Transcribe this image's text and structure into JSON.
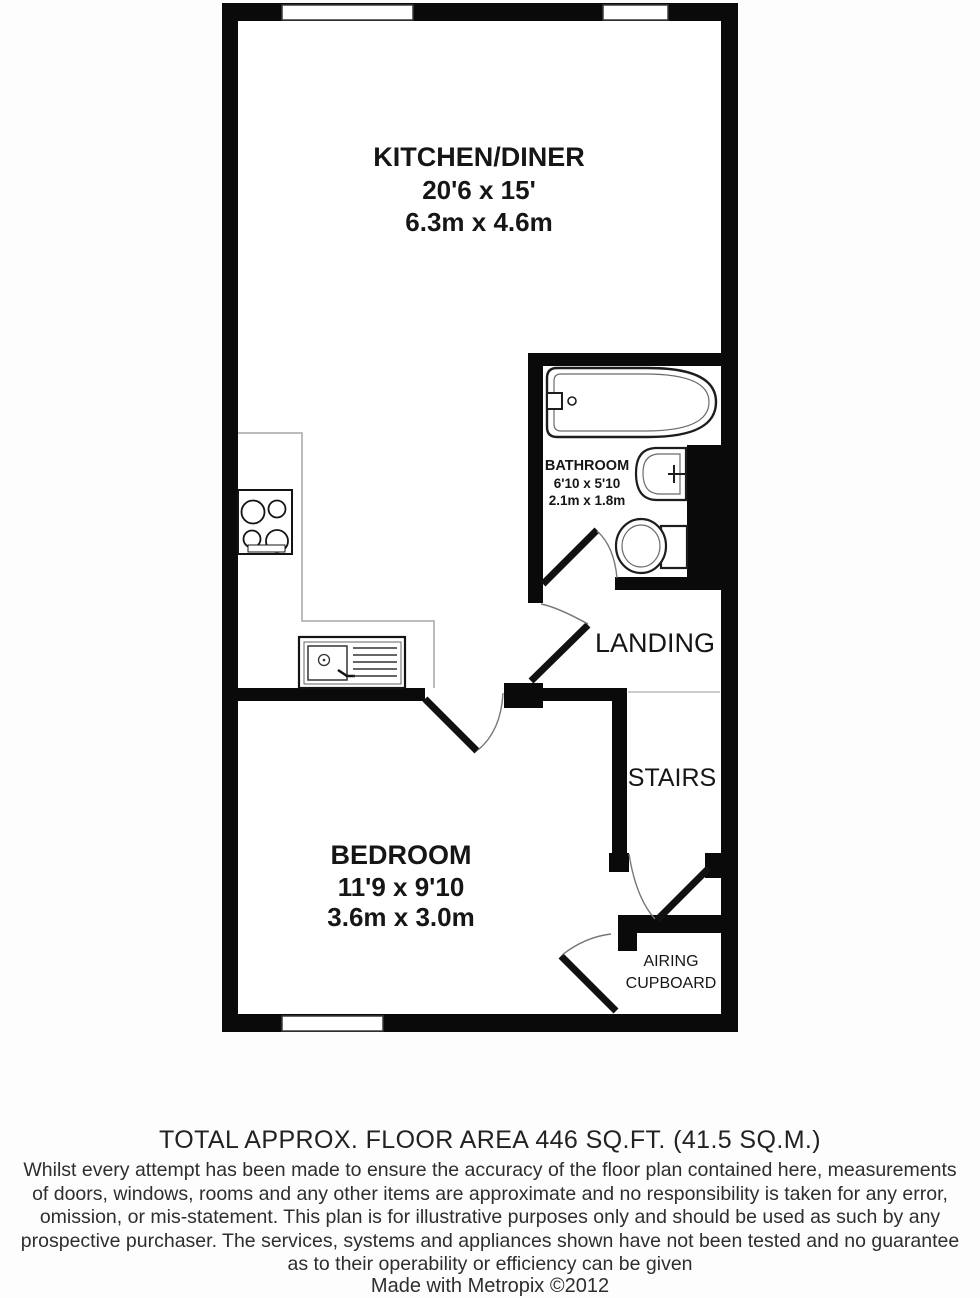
{
  "plan": {
    "rooms": {
      "kitchen": {
        "name": "KITCHEN/DINER",
        "imperial": "20'6 x 15'",
        "metric": "6.3m x 4.6m"
      },
      "bathroom": {
        "name": "BATHROOM",
        "imperial": "6'10 x 5'10",
        "metric": "2.1m x 1.8m"
      },
      "landing": {
        "name": "LANDING"
      },
      "stairs": {
        "name": "STAIRS"
      },
      "bedroom": {
        "name": "BEDROOM",
        "imperial": "11'9 x 9'10",
        "metric": "3.6m x 3.0m"
      },
      "airing_cupboard": {
        "line1": "AIRING",
        "line2": "CUPBOARD"
      }
    },
    "fixtures": [
      "bathtub",
      "washbasin",
      "toilet",
      "hob",
      "kitchen-sink",
      "worktop"
    ],
    "colors": {
      "wall": "#0a0a0a",
      "floor": "#ffffff",
      "fixture_line": "#222222",
      "thin_line": "#9a9a9a",
      "door_arc": "#777777",
      "label": "#161616"
    }
  },
  "footer": {
    "total_area": "TOTAL APPROX. FLOOR AREA 446 SQ.FT. (41.5 SQ.M.)",
    "disclaimer_lines": [
      "Whilst every attempt has been made to ensure the accuracy of the floor plan contained here, measurements",
      "of doors, windows, rooms and any other items are approximate and no responsibility is taken for any error,",
      "omission, or mis-statement. This plan is for illustrative purposes only and should be used as such by any",
      "prospective purchaser. The services, systems and appliances shown have not been tested and no guarantee",
      "as to their operability or efficiency can be given"
    ],
    "credit": "Made with Metropix ©2012"
  }
}
